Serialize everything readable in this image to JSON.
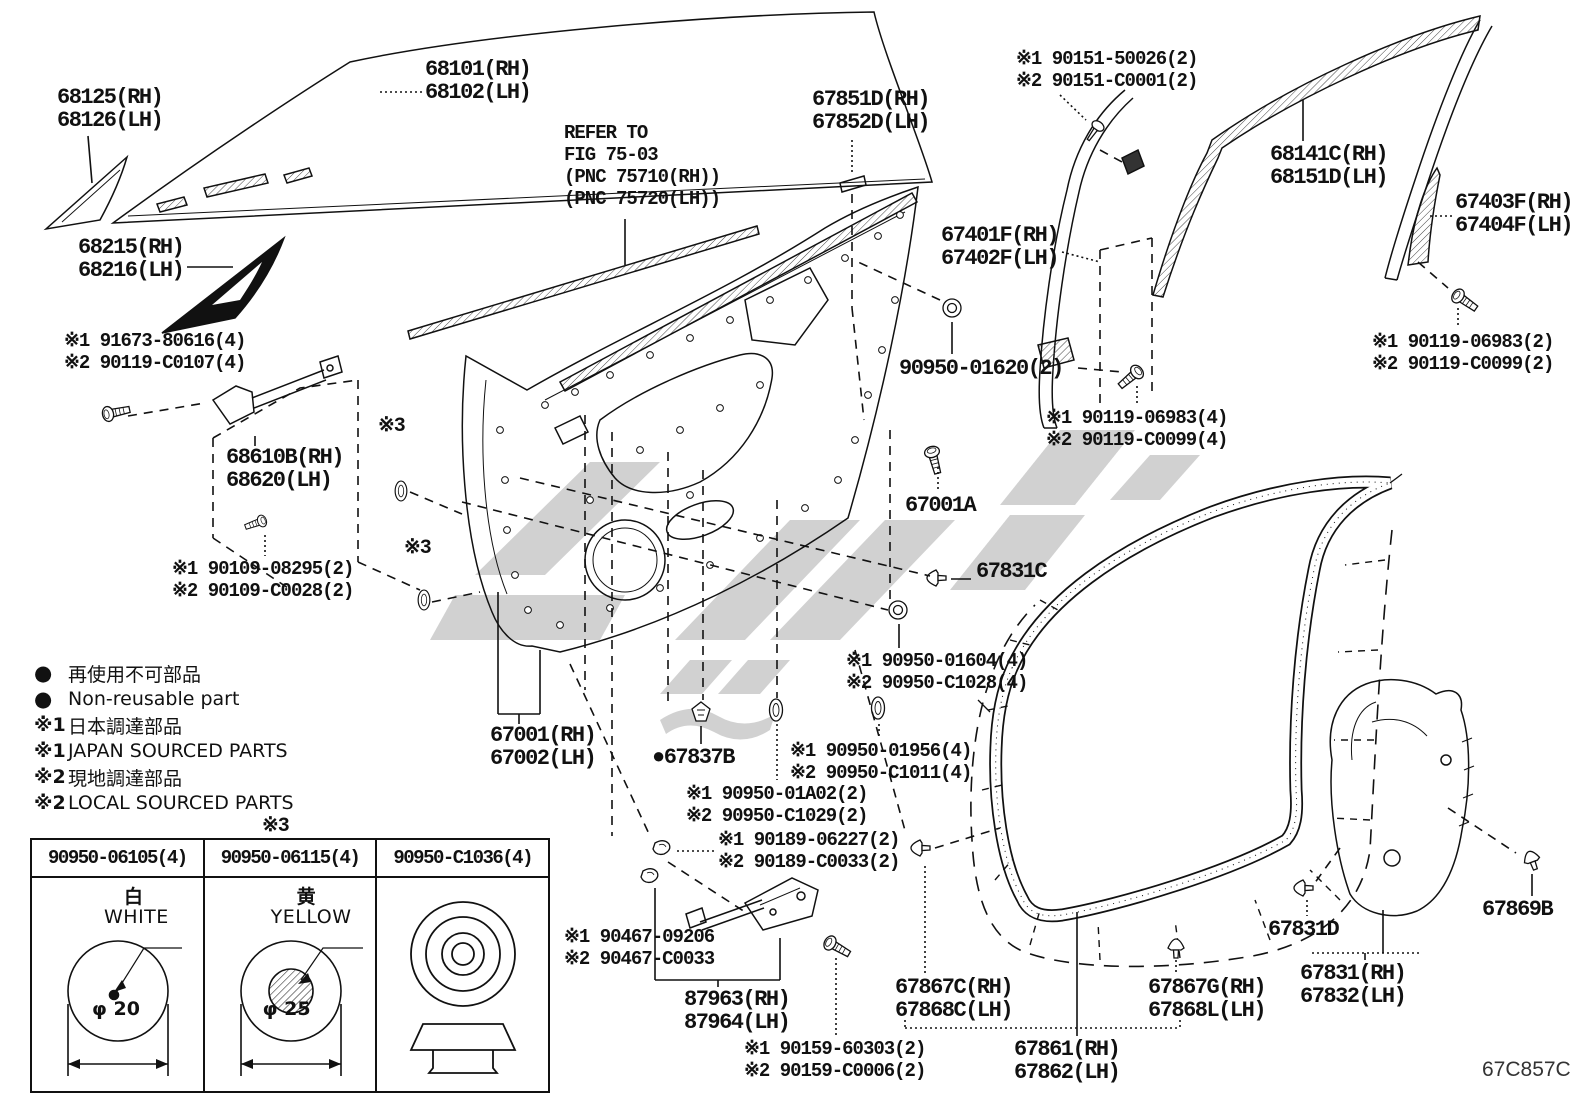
{
  "doc": {
    "code": "67C857C"
  },
  "labels": {
    "glass_vent": {
      "l1": "68125(RH)",
      "l2": "68126(LH)"
    },
    "glass_main": {
      "l1": "68101(RH)",
      "l2": "68102(LH)"
    },
    "corner_frame": {
      "l1": "68215(RH)",
      "l2": "68216(LH)"
    },
    "refer": {
      "l1": "REFER TO",
      "l2": "FIG 75-03",
      "l3": "(PNC 75710(RH))",
      "l4": "(PNC 75720(LH))"
    },
    "belt_molding": {
      "l1": "67851D(RH)",
      "l2": "67852D(LH)"
    },
    "screws_90151": {
      "l1": "※1 90151-50026(2)",
      "l2": "※2 90151-C0001(2)"
    },
    "run_68141": {
      "l1": "68141C(RH)",
      "l2": "68151D(LH)"
    },
    "run_67403": {
      "l1": "67403F(RH)",
      "l2": "67404F(LH)"
    },
    "frame_67401": {
      "l1": "67401F(RH)",
      "l2": "67402F(LH)"
    },
    "grommet_01620": {
      "l1": "90950-01620(2)"
    },
    "bolts_06983_2": {
      "l1": "※1 90119-06983(2)",
      "l2": "※2 90119-C0099(2)"
    },
    "bolts_06983_4": {
      "l1": "※1 90119-06983(4)",
      "l2": "※2 90119-C0099(4)"
    },
    "bolts_91673": {
      "l1": "※1 91673-80616(4)",
      "l2": "※2 90119-C0107(4)"
    },
    "check_68610": {
      "l1": "68610B(RH)",
      "l2": "68620(LH)"
    },
    "bolts_90109": {
      "l1": "※1 90109-08295(2)",
      "l2": "※2 90109-C0028(2)"
    },
    "panel_67001A": {
      "l1": "67001A"
    },
    "clip_67831C": {
      "l1": "67831C"
    },
    "grommets_01604": {
      "l1": "※1 90950-01604(4)",
      "l2": "※2 90950-C1028(4)"
    },
    "panel_67001": {
      "l1": "67001(RH)",
      "l2": "67002(LH)"
    },
    "clip_67837B": {
      "l1": "●67837B"
    },
    "grommets_01956": {
      "l1": "※1 90950-01956(4)",
      "l2": "※2 90950-C1011(4)"
    },
    "grommets_01A02": {
      "l1": "※1 90950-01A02(2)",
      "l2": "※2 90950-C1029(2)"
    },
    "screws_90189": {
      "l1": "※1 90189-06227(2)",
      "l2": "※2 90189-C0033(2)"
    },
    "check_90467": {
      "l1": "※1 90467-09206",
      "l2": "※2 90467-C0033"
    },
    "check_87963": {
      "l1": "87963(RH)",
      "l2": "87964(LH)"
    },
    "bolts_90159": {
      "l1": "※1 90159-60303(2)",
      "l2": "※2 90159-C0006(2)"
    },
    "strip_67867C": {
      "l1": "67867C(RH)",
      "l2": "67868C(LH)"
    },
    "clip_67867G": {
      "l1": "67867G(RH)",
      "l2": "67868L(LH)"
    },
    "weatherstrip_67861": {
      "l1": "67861(RH)",
      "l2": "67862(LH)"
    },
    "clip_67831D": {
      "l1": "67831D"
    },
    "cover_67831": {
      "l1": "67831(RH)",
      "l2": "67832(LH)"
    },
    "clip_67869B": {
      "l1": "67869B"
    },
    "marker_x3": "※3"
  },
  "legend": {
    "items": [
      {
        "sym": "●",
        "text": "再使用不可部品"
      },
      {
        "sym": "●",
        "text": "Non-reusable part"
      },
      {
        "sym": "※1",
        "text": "日本調達部品"
      },
      {
        "sym": "※1",
        "text": "JAPAN SOURCED PARTS"
      },
      {
        "sym": "※2",
        "text": "現地調達部品"
      },
      {
        "sym": "※2",
        "text": "LOCAL SOURCED PARTS"
      }
    ]
  },
  "table": {
    "marker": "※3",
    "columns": [
      {
        "part": "90950-06105(4)",
        "color_jp": "白",
        "color_en": "WHITE",
        "dia": "φ 20"
      },
      {
        "part": "90950-06115(4)",
        "color_jp": "黄",
        "color_en": "YELLOW",
        "dia": "φ 25"
      },
      {
        "part": "90950-C1036(4)",
        "color_jp": "",
        "color_en": "",
        "dia": ""
      }
    ]
  },
  "colors": {
    "line": "#111111",
    "watermark": "#c9c9c9"
  }
}
